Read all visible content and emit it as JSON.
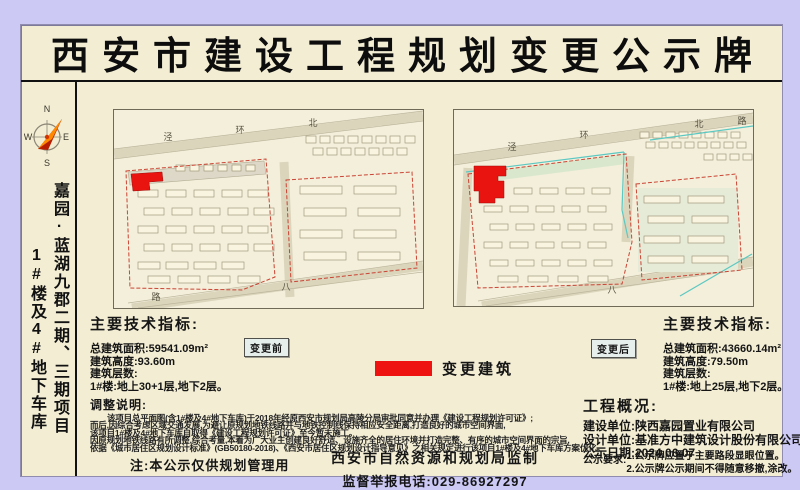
{
  "title": "西安市建设工程规划变更公示牌",
  "sidebar": {
    "project_line1": "嘉园·蓝湖九郡二期、三期项目",
    "project_line2": "1#楼及4#地下车库",
    "compass": {
      "n": "N",
      "e": "E",
      "s": "S",
      "w": "W"
    }
  },
  "maps": {
    "before": {
      "tag": "变更前",
      "road_labels": [
        {
          "t": "泾"
        },
        {
          "t": "环"
        },
        {
          "t": "北"
        },
        {
          "t": "路"
        },
        {
          "t": "八"
        }
      ]
    },
    "after": {
      "tag": "变更后",
      "road_labels": [
        {
          "t": "泾"
        },
        {
          "t": "环"
        },
        {
          "t": "北"
        },
        {
          "t": "路"
        },
        {
          "t": "八"
        }
      ]
    }
  },
  "legend": {
    "label": "变更建筑",
    "swatch_color": "#ee1211"
  },
  "indicators_before": {
    "heading": "主要技术指标:",
    "area": "总建筑面积:59541.09m²",
    "height": "建筑高度:93.60m",
    "floors_label": "建筑层数:",
    "floors_detail": "1#楼:地上30+1层,地下2层。"
  },
  "indicators_after": {
    "heading": "主要技术指标:",
    "area": "总建筑面积:43660.14m²",
    "height": "建筑高度:79.50m",
    "floors_label": "建筑层数:",
    "floors_detail": "1#楼:地上25层,地下2层。"
  },
  "adjustment": {
    "heading": "调整说明:",
    "lines": [
      "该项目总平面图(含1#楼及4#地下车库)于2018年经原西安市规划局高陵分局审批同意并办理《建设工程规划许可证》;",
      "而后,因综合考虑区域交通发展,为避让原规划地铁线路并与地铁控制线保持相应安全距离,打造良好的城市空间界面,",
      "该项目1#楼及4#地下车库自取得《建设工程规划许可证》至今暂未施工。",
      "因原规划地铁线路有所调整,综合考量,本着为广大业主创建良好舒适、设施齐全的居住环境并打造完整、有序的城市空间界面的宗旨,",
      "依据《城市居住区规划设计标准》(GB50180-2018)、《西安市居住区规划设计指导意见》之相关规定进行该项目1#楼及4#地下车库方案优化。"
    ]
  },
  "overview": {
    "heading": "工程概况:",
    "builder": "建设单位:陕西嘉园置业有限公司",
    "designer": "设计单位:基准方中建筑设计股份有限公司",
    "date": "公示日期:2024.06.07"
  },
  "note": "注:本公示仅供规划管理用",
  "footer": {
    "authority": "西安市自然资源和规划局监制",
    "phone": "监督举报电话:029-86927297",
    "req_label": "公示要求:",
    "req1": "1.公示牌应置于主要路段显眼位置。",
    "req2": "2.公示牌公示期间不得随意移撤,涂改。"
  }
}
